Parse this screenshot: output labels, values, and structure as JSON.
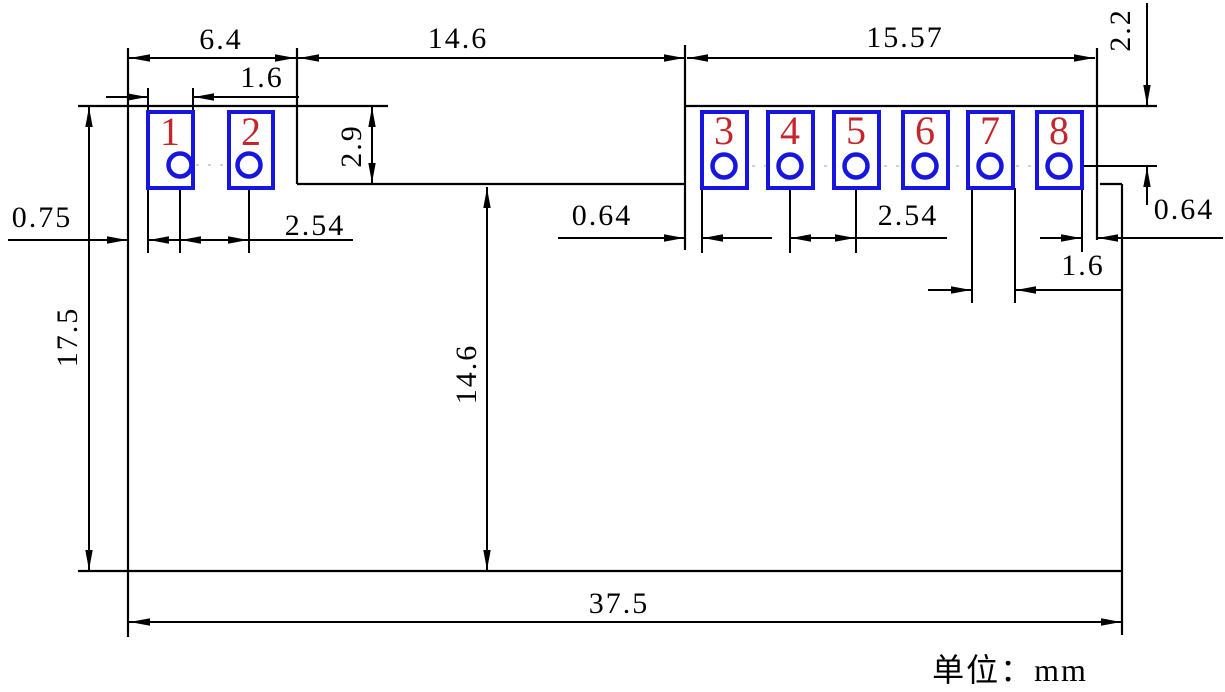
{
  "drawing": {
    "title": "connector-module-footprint-dimension-drawing",
    "unit_note": "单位：mm",
    "colors": {
      "outline": "#000000",
      "pad": "#1616e0",
      "pad_number": "#c4262b"
    },
    "pads": [
      {
        "number": "1"
      },
      {
        "number": "2"
      },
      {
        "number": "3"
      },
      {
        "number": "4"
      },
      {
        "number": "5"
      },
      {
        "number": "6"
      },
      {
        "number": "7"
      },
      {
        "number": "8"
      }
    ],
    "dims": {
      "top_left_width": "6.4",
      "pad1_width": "1.6",
      "notch_width": "14.6",
      "right_group_width": "15.57",
      "pin8_center_from_top": "2.2",
      "notch_depth": "2.9",
      "edge_to_pad1": "0.75",
      "pitch_left": "2.54",
      "notch_to_pad3": "0.64",
      "pitch_right": "2.54",
      "pad8_edge_gap": "0.64",
      "pad7_width": "1.6",
      "body_height": "17.5",
      "notch_to_bottom": "14.6",
      "body_width": "37.5"
    }
  }
}
